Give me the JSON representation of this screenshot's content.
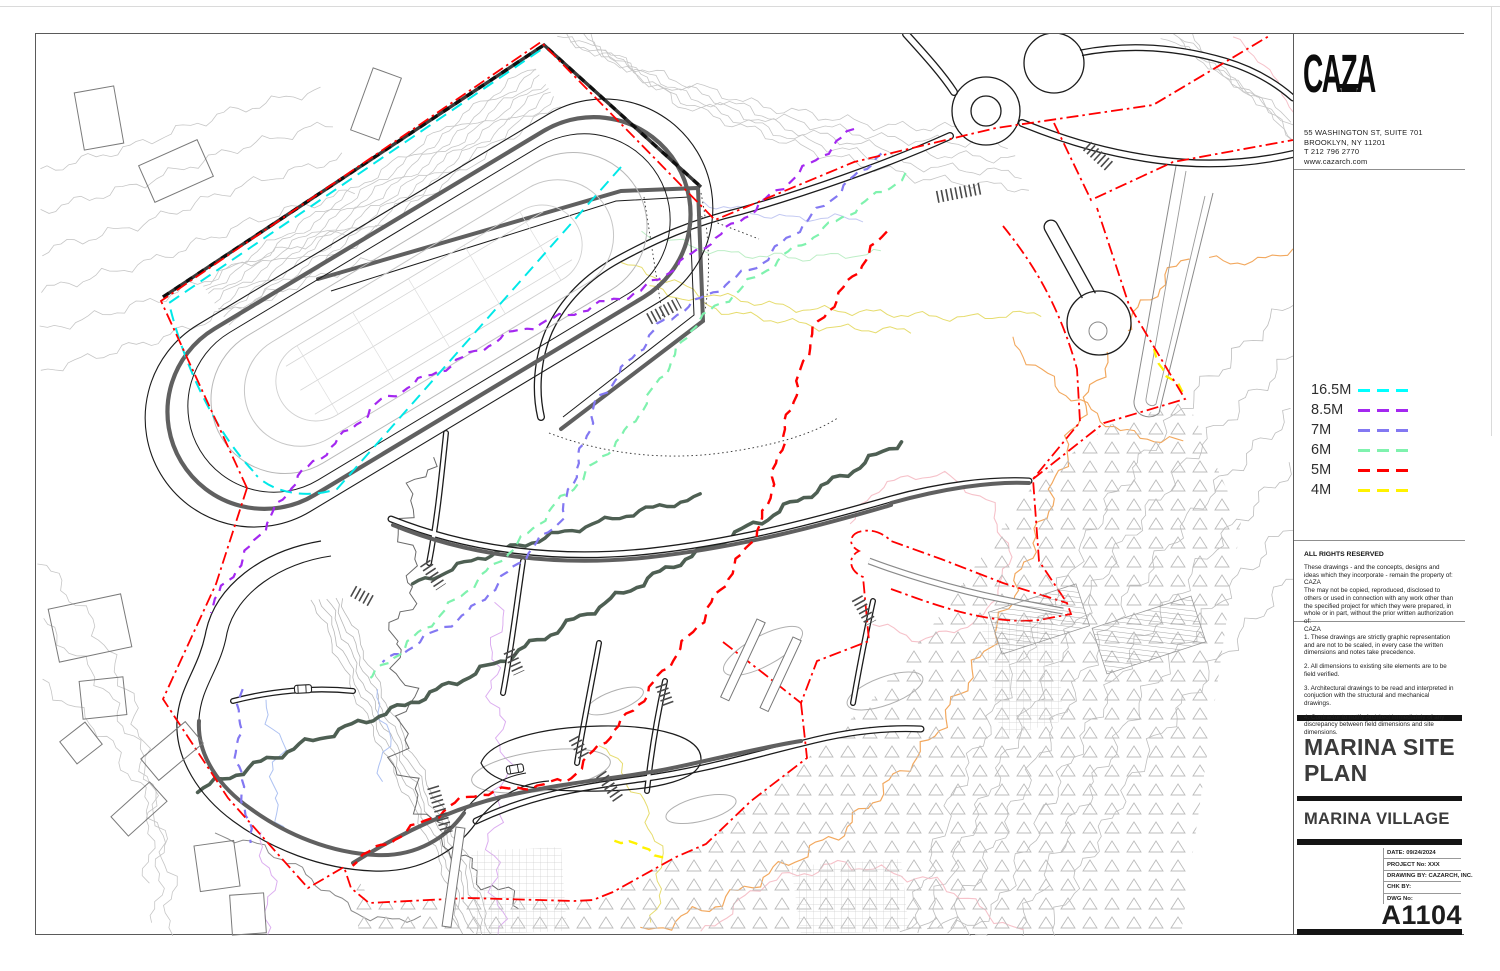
{
  "firm": {
    "logo": "CAZA",
    "address_lines": [
      "55 WASHINGTON ST, SUITE 701",
      "BROOKLYN, NY 11201",
      "T  212 796 2770",
      "www.cazarch.com"
    ]
  },
  "legend": {
    "items": [
      {
        "label": "16.5M",
        "color": "#00ffff"
      },
      {
        "label": "8.5M",
        "color": "#a428f0"
      },
      {
        "label": "7M",
        "color": "#8378f2"
      },
      {
        "label": "6M",
        "color": "#7ff2ae"
      },
      {
        "label": "5M",
        "color": "#ff0000"
      },
      {
        "label": "4M",
        "color": "#fff200"
      }
    ]
  },
  "rights": {
    "title": "ALL RIGHTS RESERVED",
    "paragraphs": [
      "These drawings - and the concepts, designs and ideas which they incorporate - remain the property of:",
      "CAZA",
      "The may not be copied, reproduced, disclosed to others or used in connection with any work other than the specified project for which they were prepared, in whole or in part, without the prior written authorization of:",
      "CAZA"
    ]
  },
  "notes": [
    "1.  These drawings are strictly graphic representation and are not to be scaled, in every case the written dimensions and notes take precedence.",
    "2.  All dimensions to existing site elements are to be field verified.",
    "3.  Architectural drawings to be read and interpreted in conjuction with the structural and mechanical drawings.",
    "4.  Contractor to notify Architect immediately of any discrepancy between field dimensions and site dimensions."
  ],
  "title_block": {
    "title": "MARINA SITE PLAN",
    "subtitle": "MARINA VILLAGE"
  },
  "info": {
    "rows": [
      {
        "label": "DATE:",
        "value": "09/24/2024"
      },
      {
        "label": "PROJECT No:",
        "value": "XXX"
      },
      {
        "label": "DRAWING BY:",
        "value": "CAZARCH, INC."
      },
      {
        "label": "CHK BY:",
        "value": ""
      },
      {
        "label": "DWG No:",
        "value": ""
      }
    ],
    "dwg_no": "A1104"
  }
}
